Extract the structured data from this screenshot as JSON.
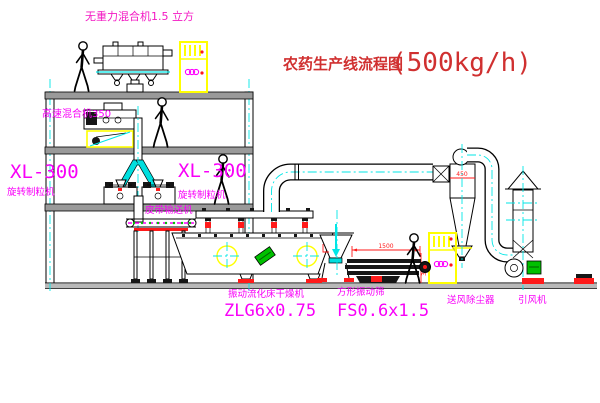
{
  "title": {
    "text": "农药生产线流程图",
    "capacity": "(500kg/h)"
  },
  "labels": {
    "gravity_mixer": "无重力混合机1.5 立方",
    "high_speed_mixer": "高速混合机350",
    "granulator_left_model": "XL-300",
    "granulator_left_name": "旋转制粒机",
    "granulator_right_model": "XL-300",
    "granulator_right_name": "旋转制粒机",
    "belt_conveyor": "皮带输送机",
    "dryer_name": "振动流化床干燥机",
    "dryer_model": "ZLG6x0.75",
    "screen_name": "方形振动筛",
    "screen_model": "FS0.6x1.5",
    "dust_collector": "送风除尘器",
    "induced_fan": "引风机"
  },
  "dimensions": {
    "screen_length": "1500",
    "screen_height": "340",
    "cyclone_diameter": "450"
  },
  "colors": {
    "label_magenta": "#f800f8",
    "label_pink": "#f318c3",
    "title_red": "#d03030",
    "dimension_red": "#ff1a1a",
    "pipe_cyan": "#00e6e6",
    "cabinet_yellow": "#ffff00",
    "motor_green": "#00c000"
  }
}
